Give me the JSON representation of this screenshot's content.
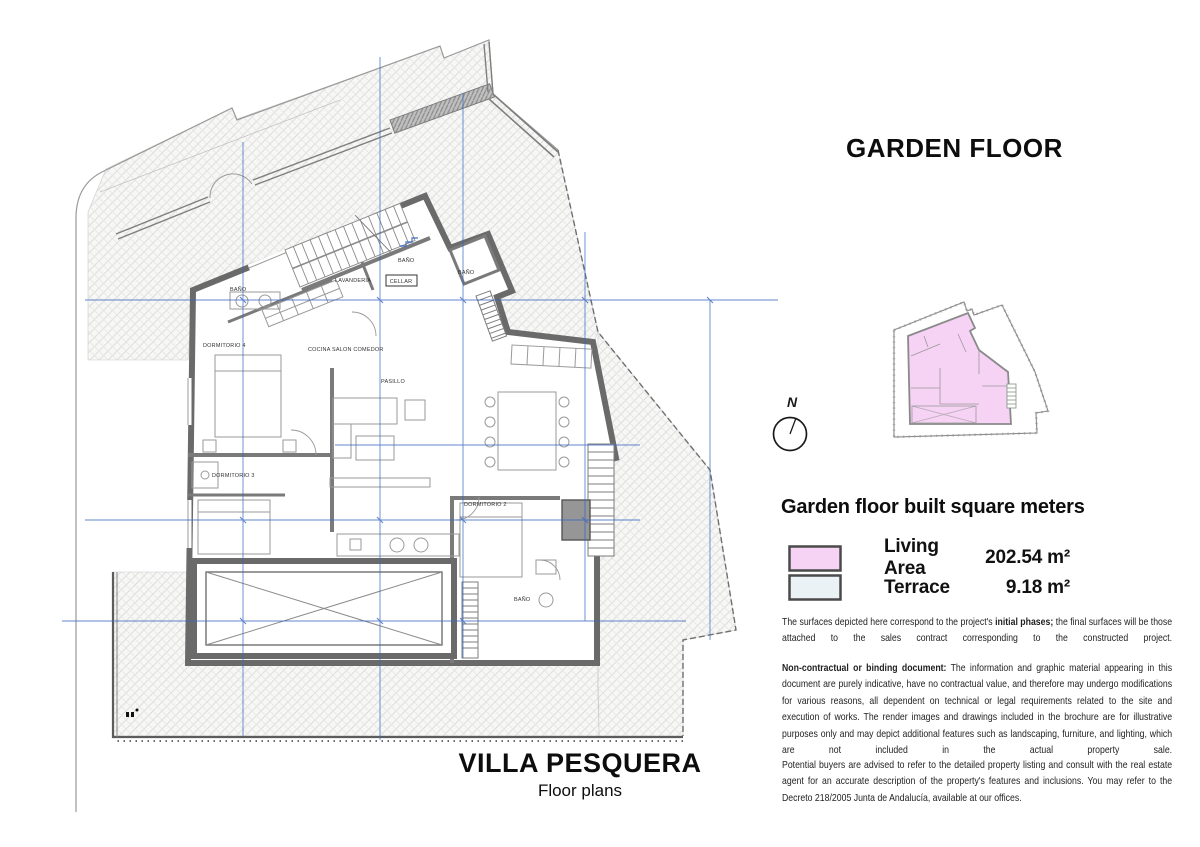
{
  "header": {
    "floor_title": "GARDEN FLOOR"
  },
  "compass": {
    "label": "N"
  },
  "legend": {
    "heading": "Garden floor built square meters",
    "rows": [
      {
        "label": "Living Area",
        "value": "202.54 m²",
        "color": "#f6d2f4"
      },
      {
        "label": "Terrace",
        "value": "9.18 m²",
        "color": "#ebf2f5"
      }
    ],
    "note_pre": "The surfaces depicted here correspond to the project's ",
    "note_bold": "initial phases;",
    "note_post": " the final surfaces will be those attached to the sales contract corresponding to the constructed project."
  },
  "disclaimer": {
    "p1_bold": "Non-contractual or binding document:",
    "p1_text": " The information and graphic material appearing in this document are purely indicative, have no contractual value, and therefore may undergo modifications for various reasons, all dependent on technical or legal requirements related to the site and execution of works. The render images and drawings included in the brochure are for illustrative purposes only and may depict additional features such as landscaping, furniture, and lighting, which are not included in the actual property sale.",
    "p2": "Potential buyers are advised to refer to the detailed property listing and consult with the real estate agent for an accurate description of the property's features and inclusions. You may refer to the Decreto 218/2005 Junta de Andalucía, available at our offices."
  },
  "footer": {
    "project_title": "VILLA PESQUERA",
    "subtitle": "Floor plans"
  },
  "plan": {
    "rooms": [
      {
        "label": "DORMITORIO 4"
      },
      {
        "label": "BAÑO"
      },
      {
        "label": "LAVANDERIA"
      },
      {
        "label": "CELLAR"
      },
      {
        "label": "BAÑO"
      },
      {
        "label": "BAÑO"
      },
      {
        "label": "COCINA SALON COMEDOR"
      },
      {
        "label": "PASILLO"
      },
      {
        "label": "DORMITORIO 3"
      },
      {
        "label": "DORMITORIO 2"
      },
      {
        "label": "BAÑO"
      }
    ],
    "colors": {
      "dimension_blue": "#3a66c0",
      "wall_gray": "#6a6a6a",
      "living_pink": "#f6d2f4",
      "terrace_blue": "#ebf2f5"
    }
  }
}
